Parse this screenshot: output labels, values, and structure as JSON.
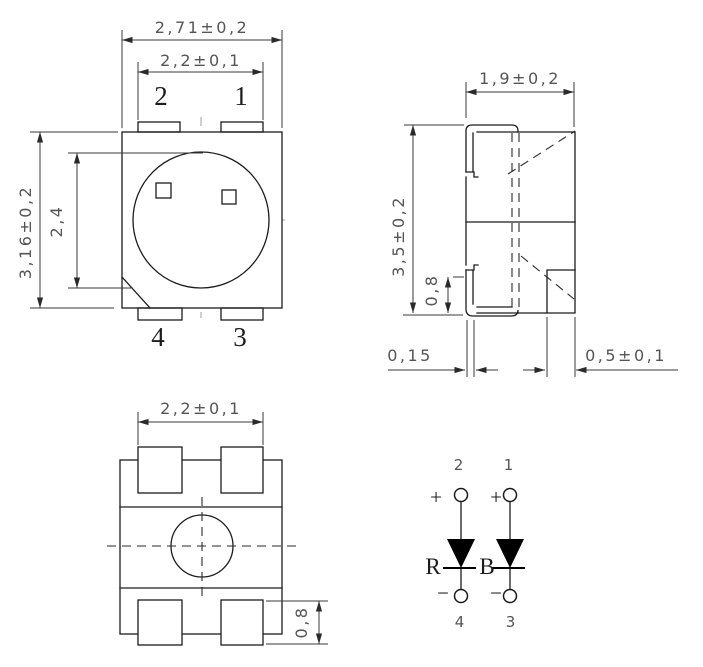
{
  "drawing": {
    "type": "SMD LED package outline drawing, 4 views: top view, side view, bottom view, circuit diagram"
  },
  "top_view": {
    "dim_overall_width": "2,71±0,2",
    "dim_pad_span": "2,2±0,1",
    "dim_overall_height": "3,16±0,2",
    "dim_lens_diameter": "2,4",
    "pin_top_left": "2",
    "pin_top_right": "1",
    "pin_bottom_left": "4",
    "pin_bottom_right": "3"
  },
  "side_view": {
    "dim_body_width": "1,9±0,2",
    "dim_overall_height": "3,5±0,2",
    "dim_lead_foot_height": "0,8",
    "dim_lead_thickness": "0,15",
    "dim_bottom_pad_width": "0,5±0,1"
  },
  "bottom_view": {
    "dim_pad_span": "2,2±0,1",
    "dim_pad_height": "0,8"
  },
  "circuit": {
    "pin_top_left": "2",
    "pin_top_right": "1",
    "pin_bottom_left": "4",
    "pin_bottom_right": "3",
    "plus_left": "+",
    "plus_right": "+",
    "minus_left": "−",
    "minus_right": "−",
    "led_left_label": "R",
    "led_right_label": "B"
  },
  "colors": {
    "line": "#1c1c1c",
    "dimension_text": "#555555",
    "centerline_gray": "#a9a9a9",
    "background": "#ffffff"
  }
}
